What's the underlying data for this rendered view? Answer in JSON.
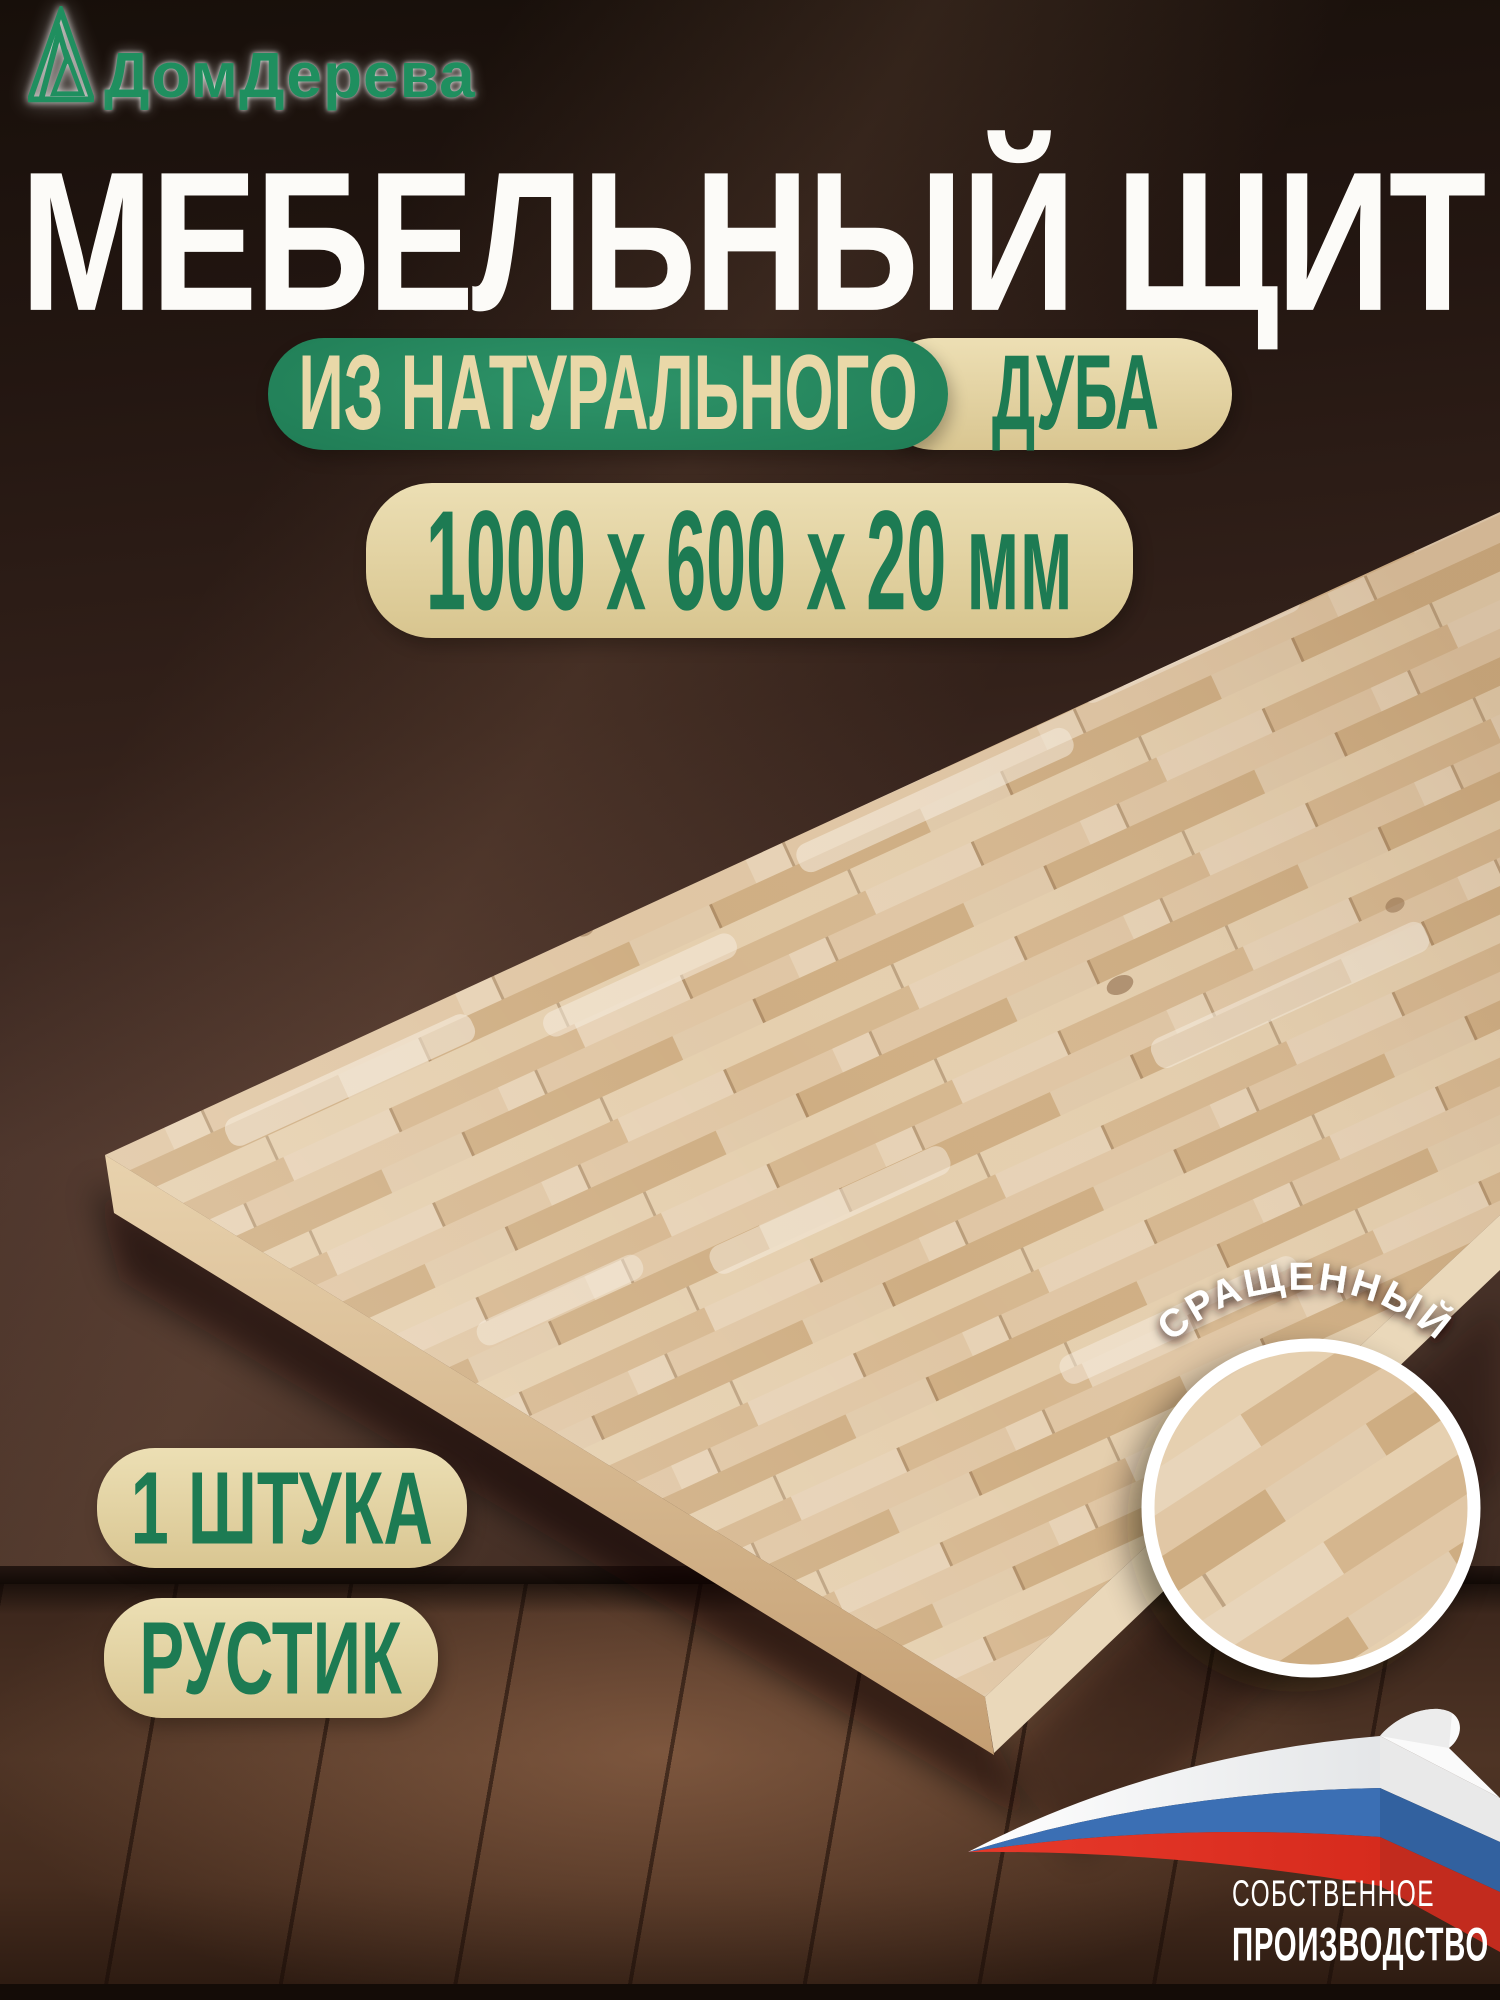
{
  "brand": {
    "name": "ДомДерева"
  },
  "title": "МЕБЕЛЬНЫЙ ЩИТ",
  "badges": {
    "material": {
      "highlight": "ИЗ НАТУРАЛЬНОГО",
      "species": "ДУБА"
    },
    "dimensions": "1000 х 600 х 20 мм",
    "quantity": "1 ШТУКА",
    "grade": "РУСТИК"
  },
  "inset": {
    "label": "СРАЩЕННЫЙ"
  },
  "production": {
    "line1": "СОБСТВЕННОЕ",
    "line2": "ПРОИЗВОДСТВО"
  },
  "colors": {
    "accent_green": "#1e7a53",
    "badge_beige": "#e6d5a4",
    "title_white": "#fcfbf8",
    "wall_brown": "#33211a",
    "floor_brown": "#4e3425",
    "wood_light": "#dcc19e",
    "flag_white": "#f5f5f5",
    "flag_blue": "#3b6fb4",
    "flag_red": "#d93226"
  }
}
